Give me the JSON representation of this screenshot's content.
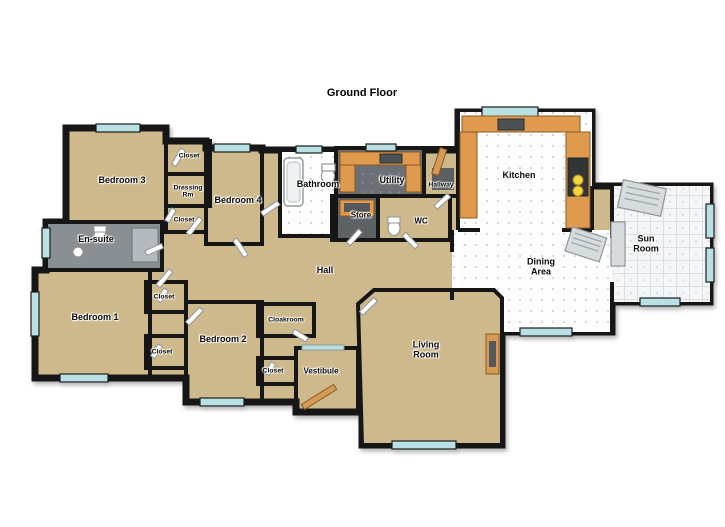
{
  "title": "Ground Floor",
  "plan": {
    "rooms": [
      {
        "id": "bedroom-3",
        "label": "Bedroom 3"
      },
      {
        "id": "closet-bedroom3-top",
        "label": "Closet"
      },
      {
        "id": "dressing-rm",
        "label": "Dressing Rm"
      },
      {
        "id": "closet-bedroom3-bottom",
        "label": "Closet"
      },
      {
        "id": "bedroom-4",
        "label": "Bedroom 4"
      },
      {
        "id": "bathroom",
        "label": "Bathroom"
      },
      {
        "id": "utility",
        "label": "Utility"
      },
      {
        "id": "hallway",
        "label": "Hallway"
      },
      {
        "id": "kitchen",
        "label": "Kitchen"
      },
      {
        "id": "store",
        "label": "Store"
      },
      {
        "id": "wc",
        "label": "WC"
      },
      {
        "id": "en-suite",
        "label": "En-suite"
      },
      {
        "id": "dining-area",
        "label": "Dining Area"
      },
      {
        "id": "sun-room",
        "label": "Sun Room"
      },
      {
        "id": "hall",
        "label": "Hall"
      },
      {
        "id": "bedroom-1",
        "label": "Bedroom 1"
      },
      {
        "id": "closet-bedroom1-top",
        "label": "Closet"
      },
      {
        "id": "closet-bedroom1-bottom",
        "label": "Closet"
      },
      {
        "id": "bedroom-2",
        "label": "Bedroom 2"
      },
      {
        "id": "cloakroom",
        "label": "Cloakroom"
      },
      {
        "id": "closet-vestibule",
        "label": "Closet"
      },
      {
        "id": "vestibule",
        "label": "Vestibule"
      },
      {
        "id": "living-room",
        "label": "Living Room"
      }
    ]
  },
  "colors": {
    "wall": "#141414",
    "carpet": "#cdb98c",
    "tile_white": "#fdfdfd",
    "tile_light_grey": "#e7eaec",
    "tile_dark_grey": "#6b7074",
    "tile_store": "#5d6266",
    "tile_ensuite": "#8a8f93",
    "window_glass": "#b9e1e4",
    "wood_door": "#d59a52",
    "kitchen_counter": "#e09a4e",
    "hob_burner": "#f5d441",
    "radiator": "#d6dbde",
    "label_text": "#0a0a0a"
  }
}
